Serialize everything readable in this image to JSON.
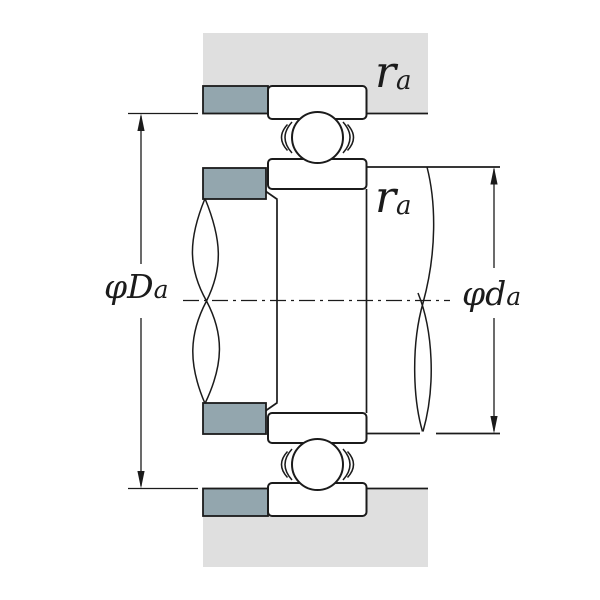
{
  "figure": {
    "title": "Bearing shaft and housing abutment / fillet dimensions diagram"
  },
  "labels": {
    "housing_abutment_diameter": {
      "symbol": "φD",
      "subscript": "a"
    },
    "shaft_abutment_diameter": {
      "symbol": "φd",
      "subscript": "a"
    },
    "fillet_radius_housing": {
      "symbol": "r",
      "subscript": "a"
    },
    "fillet_radius_shaft": {
      "symbol": "r",
      "subscript": "a"
    }
  },
  "colors": {
    "background": "#ffffff",
    "housing_fill": "#dfdfdf",
    "shoulder_fill": "#93a6ae",
    "line": "#1b1b1b"
  }
}
